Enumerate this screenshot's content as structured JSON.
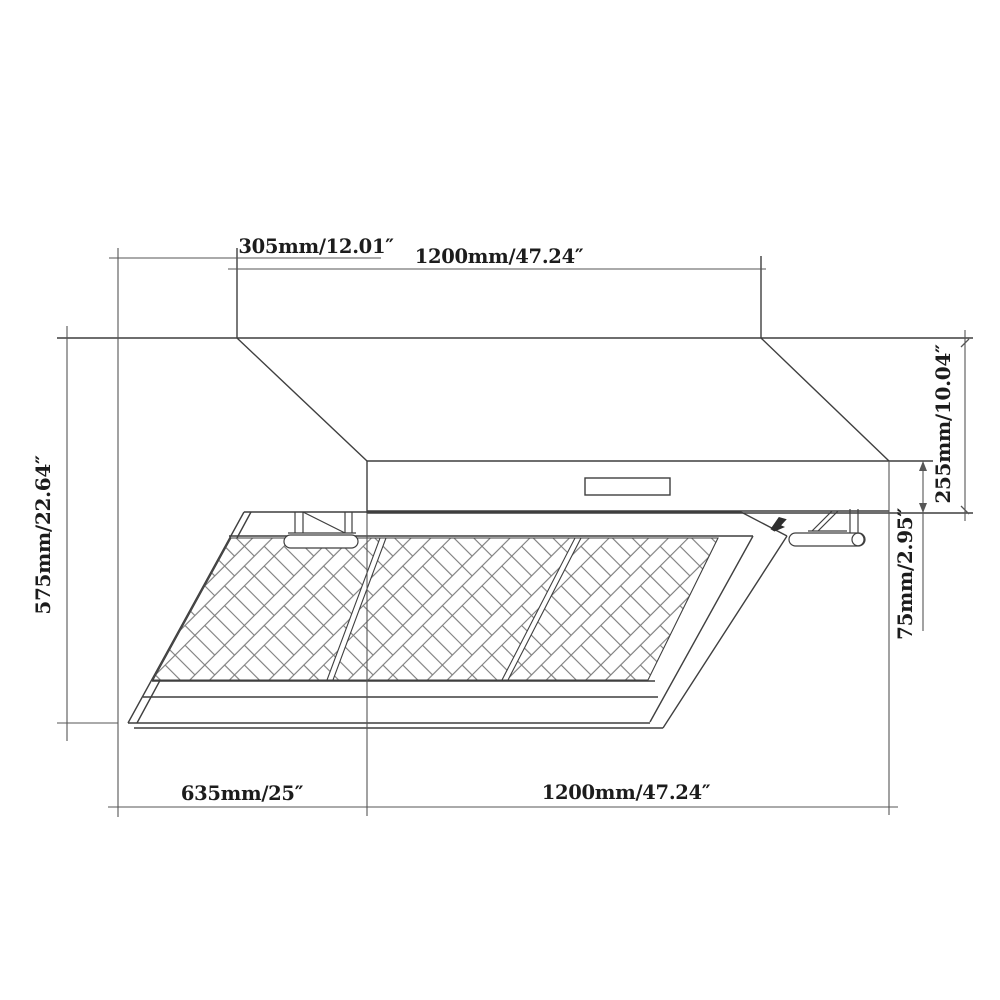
{
  "page": {
    "background": "#ffffff"
  },
  "drawing": {
    "name": "range-hood-dimensional-drawing",
    "line_color": "#3f3f3f",
    "dim_line_color": "#565656",
    "pattern_line_color": "#7d7d7d",
    "labels": {
      "chimney_depth": "305mm/12.01″",
      "top_width": "1200mm/47.24″",
      "hood_height": "255mm/10.04″",
      "body_height": "75mm/2.95″",
      "total_height": "575mm/22.64″",
      "bottom_depth": "635mm/25″",
      "bottom_width": "1200mm/47.24″"
    }
  }
}
